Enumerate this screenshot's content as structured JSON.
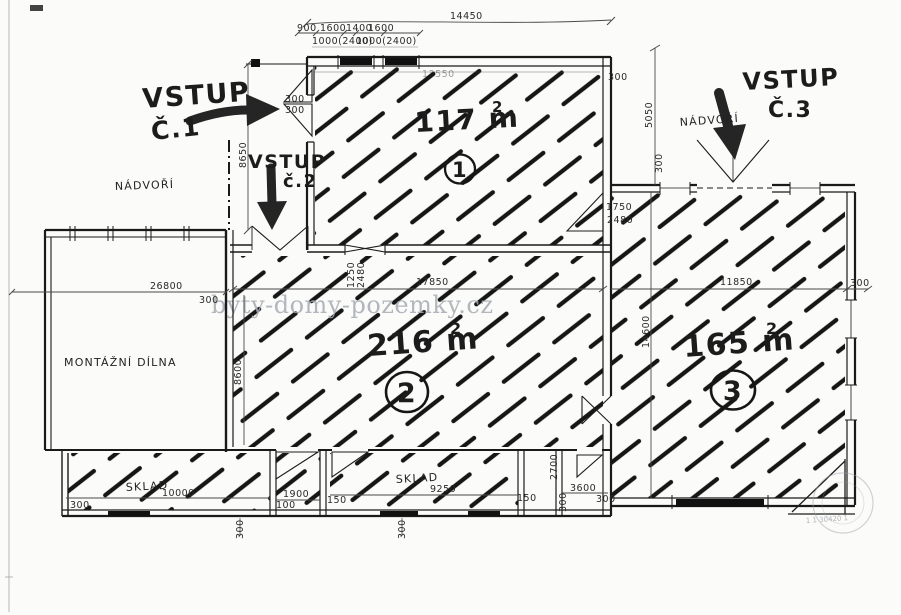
{
  "watermark": {
    "text": "byty-domy-pozemky.cz"
  },
  "entrances": {
    "e1": {
      "line1": "VSTUP",
      "line2": "Č.1"
    },
    "e2": {
      "line1": "VSTUP",
      "line2": "č.2"
    },
    "e3": {
      "line1": "VSTUP",
      "line2": "Č.3"
    }
  },
  "areas": {
    "a1": {
      "size": "117 m",
      "sup": "2",
      "number": "1"
    },
    "a2": {
      "size": "216 m",
      "sup": "2",
      "number": "2"
    },
    "a3": {
      "size": "165 m",
      "sup": "2",
      "number": "3"
    }
  },
  "rooms": {
    "courtyard_left": "NÁDVOŘÍ",
    "courtyard_right": "NÁDVOŘÍ",
    "workshop": "MONTÁŽNÍ DÍLNA",
    "storage1": "SKLAD",
    "storage2": "SKLAD"
  },
  "dims": {
    "top_total": "14450",
    "seg1": "900",
    "seg2": "1600",
    "seg3": "1400",
    "seg4": "1600",
    "win1": "1000(2400)",
    "win2": "1000(2400)",
    "area1_inner": "13550",
    "area2_width": "17850",
    "area3_width": "11850",
    "left_width": "26800",
    "courtyard_h": "8650",
    "workshop_h": "8600",
    "right_h": "5050",
    "area3_h": "14600",
    "door_a": "1250",
    "door_b": "2480",
    "door_c": "1750",
    "sklad1_len": "10000",
    "sklad2_len": "9250",
    "room_b_w": "1900",
    "room_e_w": "3600",
    "room_d_h": "2700",
    "d100": "100",
    "d150": "150",
    "d300": "300"
  },
  "stamp": {
    "code": "1 1 30420 1"
  },
  "colors": {
    "ink": "#1a1a1a",
    "hatch": "#161616",
    "dimension": "#444444",
    "watermark": "#a6abb3",
    "paper": "#fbfbf9"
  }
}
